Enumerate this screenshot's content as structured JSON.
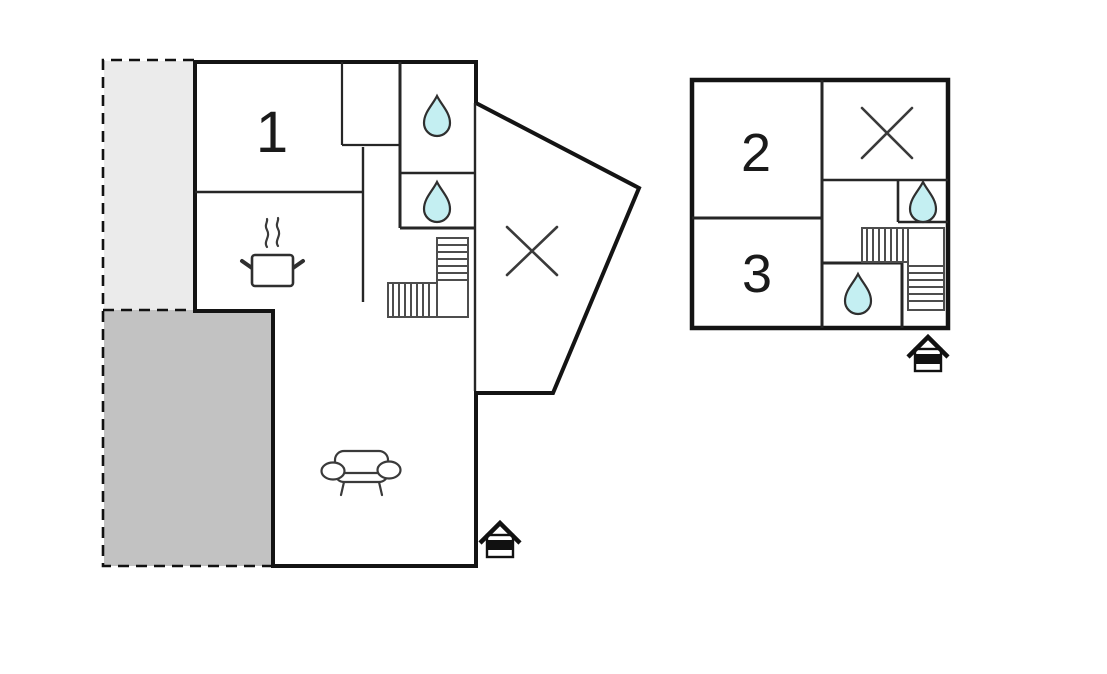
{
  "canvas": {
    "width": 1107,
    "height": 674,
    "background": "#ffffff"
  },
  "colors": {
    "outer_wall": "#141414",
    "interior_wall": "#262626",
    "stairs_stroke": "#4d4d4d",
    "fixture_stroke": "#3a3a3a",
    "water_fill": "#c4eff2",
    "water_stroke": "#2f2f2f",
    "terrace_light": "#ebebeb",
    "terrace_dark": "#c2c2c2",
    "label": "#1a1a1a"
  },
  "ground_floor": {
    "rooms": [
      {
        "label": "1"
      }
    ],
    "icons": [
      {
        "name": "water-drop-icon"
      },
      {
        "name": "water-drop-icon"
      },
      {
        "name": "room-cross-icon"
      },
      {
        "name": "stairs-icon"
      },
      {
        "name": "cooking-pot-icon"
      },
      {
        "name": "sofa-icon"
      },
      {
        "name": "entrance-icon"
      }
    ],
    "areas": [
      {
        "name": "terrace-upper"
      },
      {
        "name": "terrace-lower"
      }
    ]
  },
  "upper_floor": {
    "rooms": [
      {
        "label": "2"
      },
      {
        "label": "3"
      }
    ],
    "icons": [
      {
        "name": "water-drop-icon"
      },
      {
        "name": "water-drop-icon"
      },
      {
        "name": "room-cross-icon"
      },
      {
        "name": "stairs-icon"
      },
      {
        "name": "entrance-icon"
      }
    ]
  }
}
